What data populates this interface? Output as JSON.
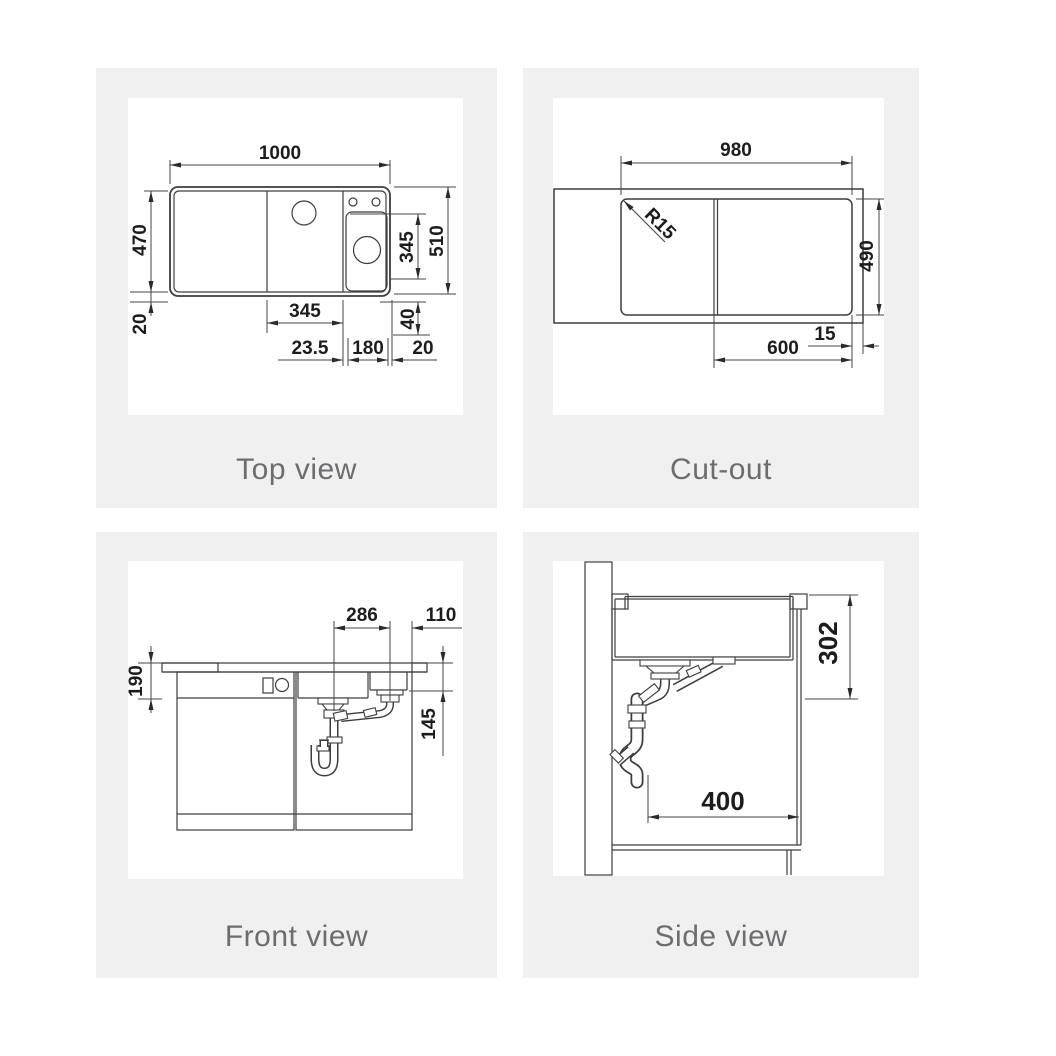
{
  "style": {
    "panel_bg": "#f0f0f1",
    "line_color": "#3d3d3d",
    "dim_text_color": "#1c1c1c",
    "caption_color": "#6d6d70"
  },
  "panels": [
    {
      "id": "top-view",
      "caption": "Top view",
      "dims": {
        "overall_width": "1000",
        "inner_depth": "470",
        "rim_bottom": "20",
        "main_bowl_width": "345",
        "gap": "23.5",
        "small_bowl_width": "180",
        "rim_right": "20",
        "small_bowl_depth": "345",
        "offset_40": "40",
        "overall_depth": "510"
      }
    },
    {
      "id": "cut-out",
      "caption": "Cut-out",
      "dims": {
        "cutout_width": "980",
        "corner_radius": "R15",
        "cutout_depth": "490",
        "edge_offset": "15",
        "bowl_section": "600"
      }
    },
    {
      "id": "front-view",
      "caption": "Front view",
      "dims": {
        "drain_spacing": "286",
        "drain_offset": "110",
        "left_depth": "190",
        "right_depth": "145"
      }
    },
    {
      "id": "side-view",
      "caption": "Side view",
      "dims": {
        "mounting_depth": "302",
        "cabinet_depth": "400"
      }
    }
  ]
}
